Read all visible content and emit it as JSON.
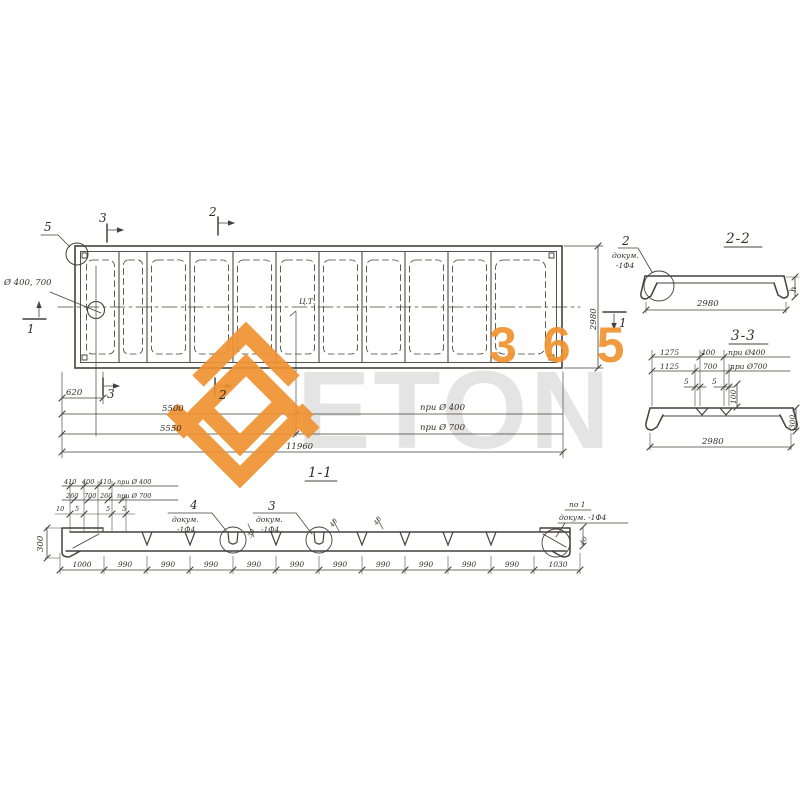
{
  "watermark": {
    "word": "ETON",
    "digits": "365",
    "orange": "#F0922E",
    "gray": "#E4E4E4"
  },
  "plan": {
    "detail_label": "5",
    "section_top_left": "3",
    "section_top_mid": "2",
    "hole_note": "Ø 400, 700",
    "section_left": "1",
    "section_right": "1",
    "centroid_label": "Ц.Т.",
    "section_bottom_left": "3",
    "section_bottom_mid": "2",
    "dims": {
      "d620": "620",
      "d5500": "5500",
      "note_400": "при Ø 400",
      "d5550": "5550",
      "note_700": "при Ø 700",
      "d11960": "11960",
      "width_2980": "2980"
    }
  },
  "section_2_2": {
    "title": "2-2",
    "callout": {
      "num": "2",
      "line1": "докум.",
      "line2": "-1Ф4"
    },
    "dim_width": "2980",
    "dim_height": "h"
  },
  "section_3_3": {
    "title": "3-3",
    "row1": [
      "1275",
      "400",
      "при Ø400"
    ],
    "row2": [
      "1125",
      "700",
      "при Ø700"
    ],
    "gap1": "5",
    "gap2": "5",
    "dim_depth": "100",
    "dim_height": "300",
    "dim_width": "2980"
  },
  "section_1_1": {
    "title": "1-1",
    "top_row1": [
      "410",
      "400",
      "410",
      "при Ø 400"
    ],
    "top_row2": [
      "260",
      "700",
      "260",
      "при Ø 700"
    ],
    "small_dims": [
      "10",
      "5",
      "5",
      "5"
    ],
    "callout_4": {
      "num": "4",
      "line1": "докум.",
      "line2": "-1Ф4"
    },
    "callout_3": {
      "num": "3",
      "line1": "докум.",
      "line2": "-1Ф4"
    },
    "dim_30": "30",
    "rib_dim_a": "40",
    "rib_dim_b": "40",
    "end_dim": "40",
    "end_callout": {
      "line1": "по 1",
      "line2": "докум. -1Ф4"
    },
    "dim_height": "300",
    "bottom_dims": [
      "1000",
      "990",
      "990",
      "990",
      "990",
      "990",
      "990",
      "990",
      "990",
      "990",
      "990",
      "1030"
    ]
  }
}
